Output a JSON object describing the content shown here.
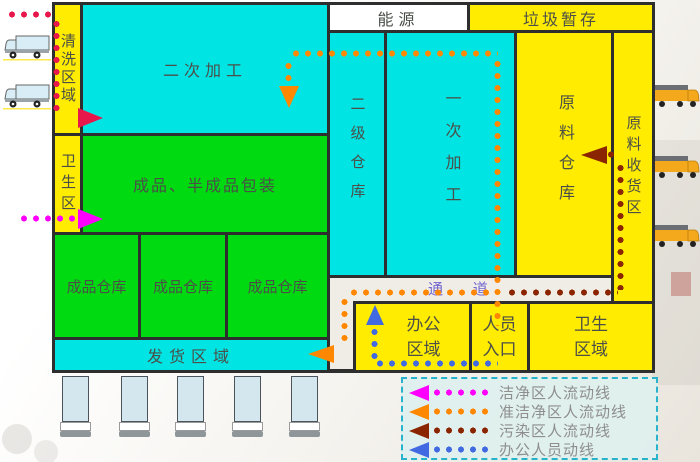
{
  "rooms": {
    "wash_area": "清洗区域",
    "secondary_processing": "二次加工",
    "hygiene_strip": "卫生区",
    "packaging": "成品、半成品包装",
    "finished_warehouses": [
      "成品仓库",
      "成品仓库",
      "成品仓库"
    ],
    "shipping_area": "发货区域",
    "energy": "能源",
    "garbage_storage": "垃圾暂存",
    "secondary_warehouse": "二级仓库",
    "primary_processing": "一次加工",
    "raw_material_warehouse": "原料仓库",
    "raw_material_receiving": "原料收货区",
    "corridor": "通 道",
    "office_area": "办公区域",
    "personnel_entrance": "人员入口",
    "hygiene_area": "卫生区域"
  },
  "legend": {
    "items": [
      {
        "label": "洁净区人流动线",
        "color": "#ff00ff"
      },
      {
        "label": "准洁净区人流动线",
        "color": "#ff8800"
      },
      {
        "label": "污染区人流动线",
        "color": "#8b2500"
      },
      {
        "label": "办公人员动线",
        "color": "#4169e1"
      }
    ]
  },
  "colors": {
    "processing_rooms": "#00e4e4",
    "clean_rooms": "#00da10",
    "general_rooms": "#ffec00",
    "walls": "#2e2e2e",
    "clean_flow": "#ff00ff",
    "quasi_clean_flow": "#ff8800",
    "contaminated_flow": "#8b2500",
    "office_flow": "#4169e1",
    "outside_entry_flow": "#e8174b",
    "corridor_label": "#7466cf"
  }
}
